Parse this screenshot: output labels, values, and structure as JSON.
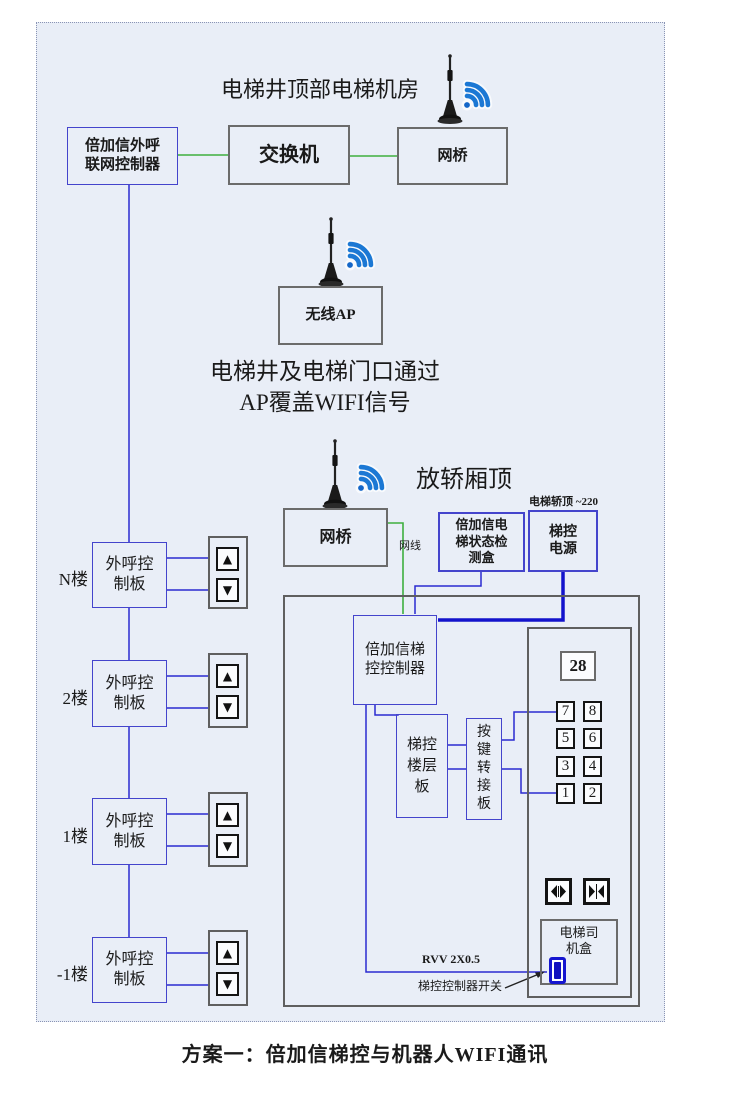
{
  "colors": {
    "diagram_bg": "#e9eef7",
    "blue_box_border": "#4444cc",
    "blue_line": "#2a2ad0",
    "power_line": "#1313cc",
    "gray_border": "#6b6b6b",
    "green_line": "#3faf3f",
    "wifi_blue": "#1c78d4",
    "switch_blue": "#1515d0"
  },
  "icons": {
    "up_arrow": "▲",
    "down_arrow": "▼"
  },
  "machine_room": {
    "title": "电梯井顶部电梯机房",
    "outcall_controller": "倍加信外呼联网控制器",
    "switch": "交换机",
    "bridge": "网桥"
  },
  "shaft": {
    "ap": "无线AP",
    "note_line1": "电梯井及电梯门口通过",
    "note_line2": "AP覆盖WIFI信号"
  },
  "car_top": {
    "title": "放轿厢顶",
    "bridge": "网桥",
    "cable": "网线",
    "detector": "倍加信电梯状态检测盒",
    "power_note": "电梯轿顶 ~220",
    "power": "梯控电源"
  },
  "car_panel": {
    "controller": "倍加信梯控控制器",
    "floor_board": "梯控楼层板",
    "key_adapter": "按键转接板",
    "display": "28",
    "keys": [
      "7",
      "8",
      "5",
      "6",
      "3",
      "4",
      "1",
      "2"
    ],
    "driver_box": "电梯司机盒",
    "cable_label": "RVV 2X0.5",
    "switch_label": "梯控控制器开关"
  },
  "floors": [
    {
      "label": "N楼",
      "board": "外呼控制板"
    },
    {
      "label": "2楼",
      "board": "外呼控制板"
    },
    {
      "label": "1楼",
      "board": "外呼控制板"
    },
    {
      "label": "-1楼",
      "board": "外呼控制板"
    }
  ],
  "caption": "方案一：倍加信梯控与机器人WIFI通讯"
}
